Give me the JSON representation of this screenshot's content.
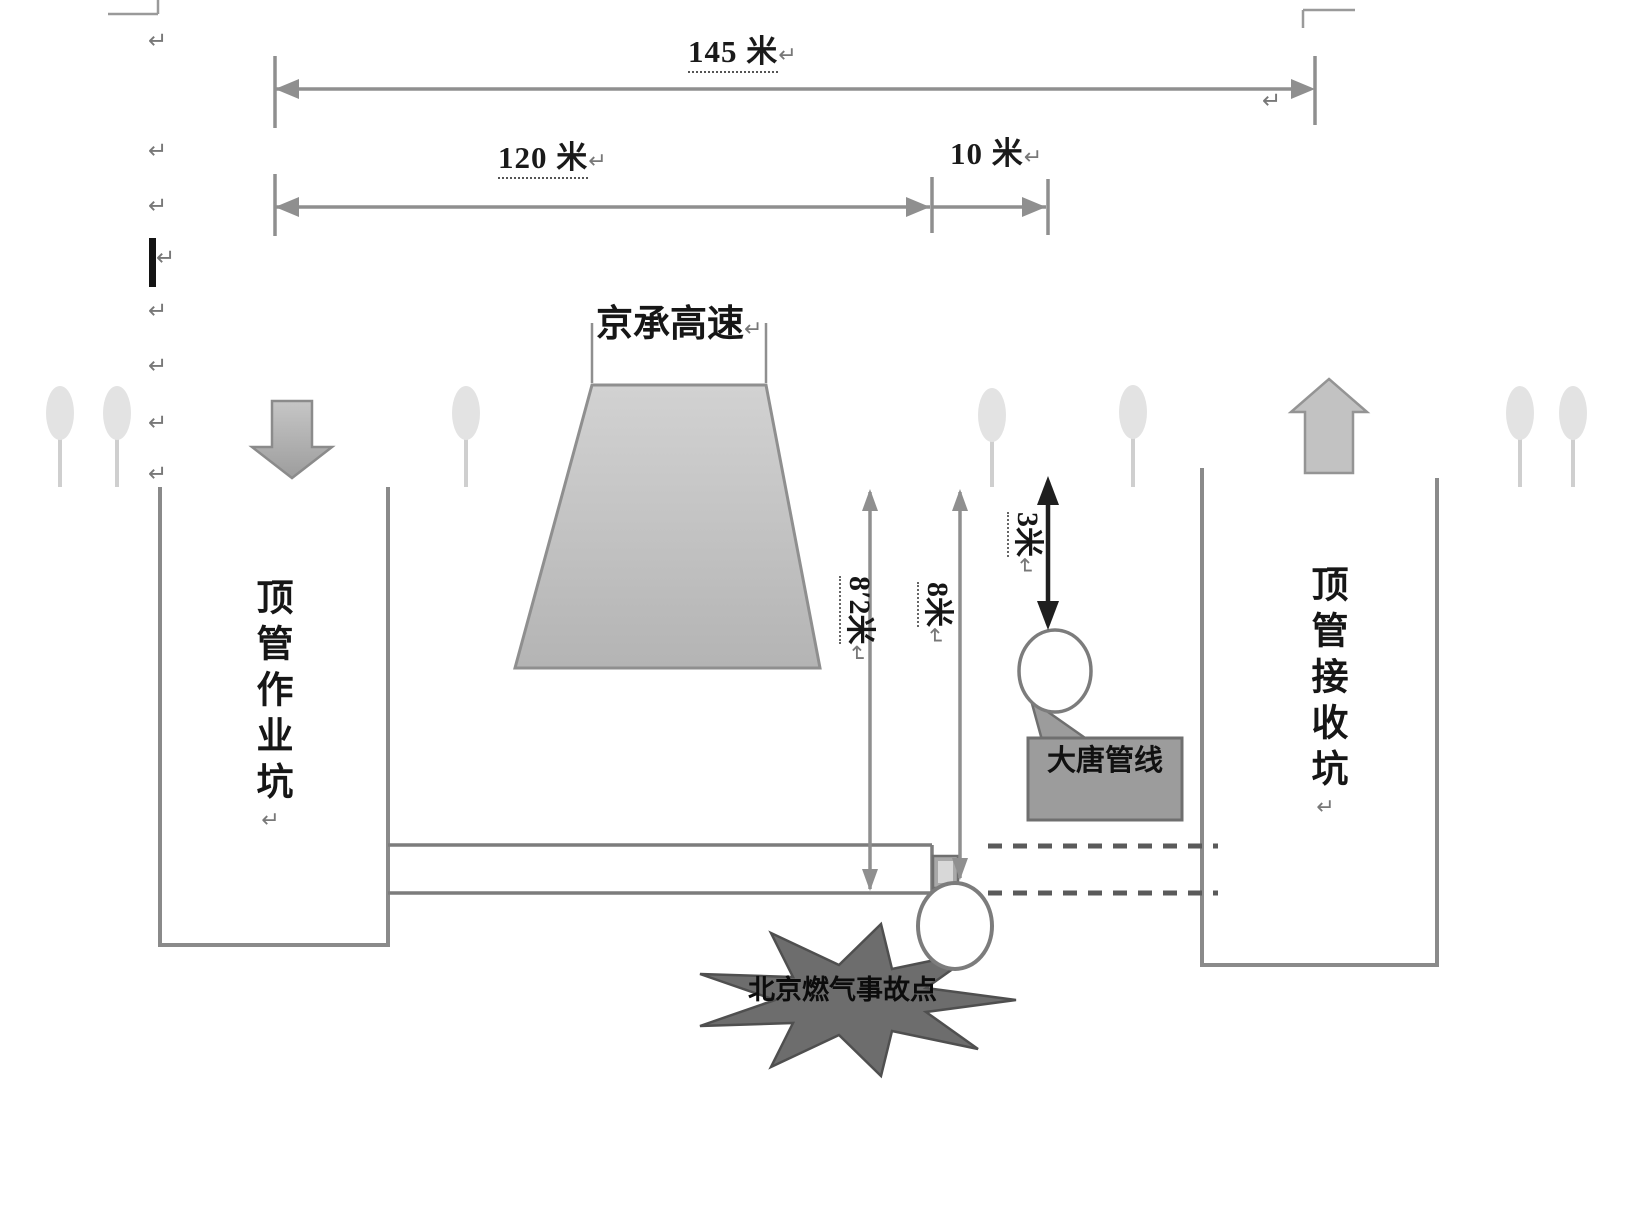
{
  "diagram": {
    "dimensions": {
      "total": {
        "label": "145 米"
      },
      "left_span": {
        "label": "120 米"
      },
      "right_span": {
        "label": "10 米"
      },
      "depth_pipe": {
        "label": "8′2米"
      },
      "depth_gas": {
        "label": "8米"
      },
      "depth_datang": {
        "label": "3米"
      }
    },
    "features": {
      "expressway": "京承高速",
      "working_pit": "顶管作业坑",
      "receiving_pit": "顶管接收坑",
      "datang_pipeline": "大唐管线",
      "accident_point": "北京燃气事故点"
    },
    "marks": {
      "paragraph": "↵"
    },
    "colors": {
      "line_gray": "#8f8f8f",
      "wall_gray": "#8a8a8a",
      "road_fill": "#c9c9c9",
      "callout_fill": "#9c9c9c",
      "burst_fill": "#6d6d6d",
      "black_dim": "#1f1f1f"
    }
  }
}
